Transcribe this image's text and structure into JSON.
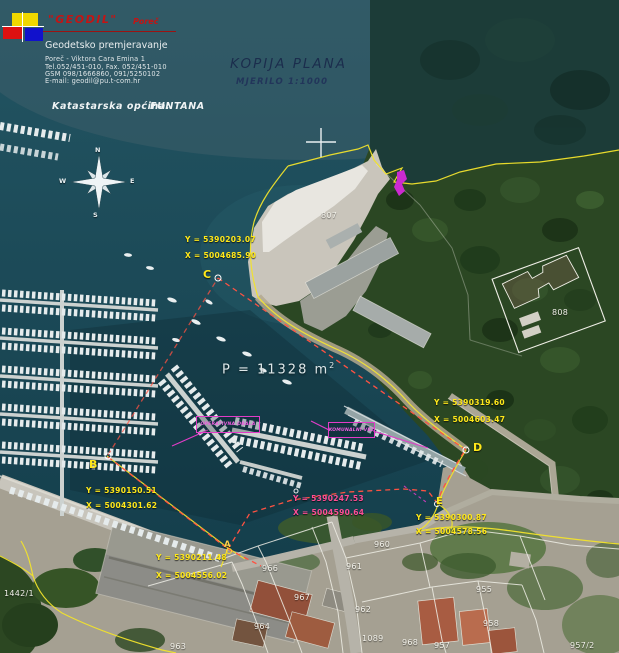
{
  "header": {
    "logo": {
      "name": "\"GEODIL\"",
      "city": "Poreč"
    },
    "company_lines": [
      "Geodetsko premjeravanje",
      "Poreč - Viktora Cara Emina 1",
      "Tel.052/451-010, Fax. 052/451-010",
      "GSM 098/1666860, 091/5250102",
      "E-mail: geodil@pu.t-com.hr"
    ],
    "cadastral_label": "Katastarska  općina:",
    "cadastral_value": "FUNTANA"
  },
  "title": {
    "main": "KOPIJA  PLANA",
    "scale": "MJERILO  1:1000"
  },
  "area": {
    "label": "P  =  11328  m",
    "exponent": "2"
  },
  "compass": {
    "n": "N",
    "e": "E",
    "s": "S",
    "w": "W"
  },
  "survey_points": [
    {
      "id": "C",
      "y_coord": "Y = 5390203.07",
      "x_coord": "X = 5004685.90"
    },
    {
      "id": "B",
      "y_coord": "Y = 5390150.51",
      "x_coord": "X = 5004301.62"
    },
    {
      "id": "D",
      "y_coord": "Y = 5390319.60",
      "x_coord": "X = 5004603.47"
    },
    {
      "id": "E",
      "y_coord": "Y = 5390300.87",
      "x_coord": "X = 5004578.56"
    },
    {
      "id": "A",
      "y_coord": "Y = 5390211.48",
      "x_coord": "X = 5004556.02"
    },
    {
      "id": "",
      "y_coord": "Y = 5390247.53",
      "x_coord": "X = 5004590.64"
    }
  ],
  "zone_labels": {
    "operativna_obala": "OPERATIVNA OBALA",
    "komunalni_vez": "KOMUNALNI VEZ"
  },
  "parcels": [
    {
      "label": "807"
    },
    {
      "label": "808"
    },
    {
      "label": "960"
    },
    {
      "label": "961"
    },
    {
      "label": "966"
    },
    {
      "label": "967"
    },
    {
      "label": "955"
    },
    {
      "label": "962"
    },
    {
      "label": "964"
    },
    {
      "label": "1089"
    },
    {
      "label": "968"
    },
    {
      "label": "958"
    },
    {
      "label": "963"
    },
    {
      "label": "957"
    },
    {
      "label": "957/2"
    },
    {
      "label": "1442/1"
    }
  ],
  "colors": {
    "survey_yellow": "#ffe81a",
    "survey_red": "#ff5242",
    "survey_magenta": "#e23cc8",
    "parcel_white": "#f2f1ea",
    "sea": "#17434f"
  }
}
